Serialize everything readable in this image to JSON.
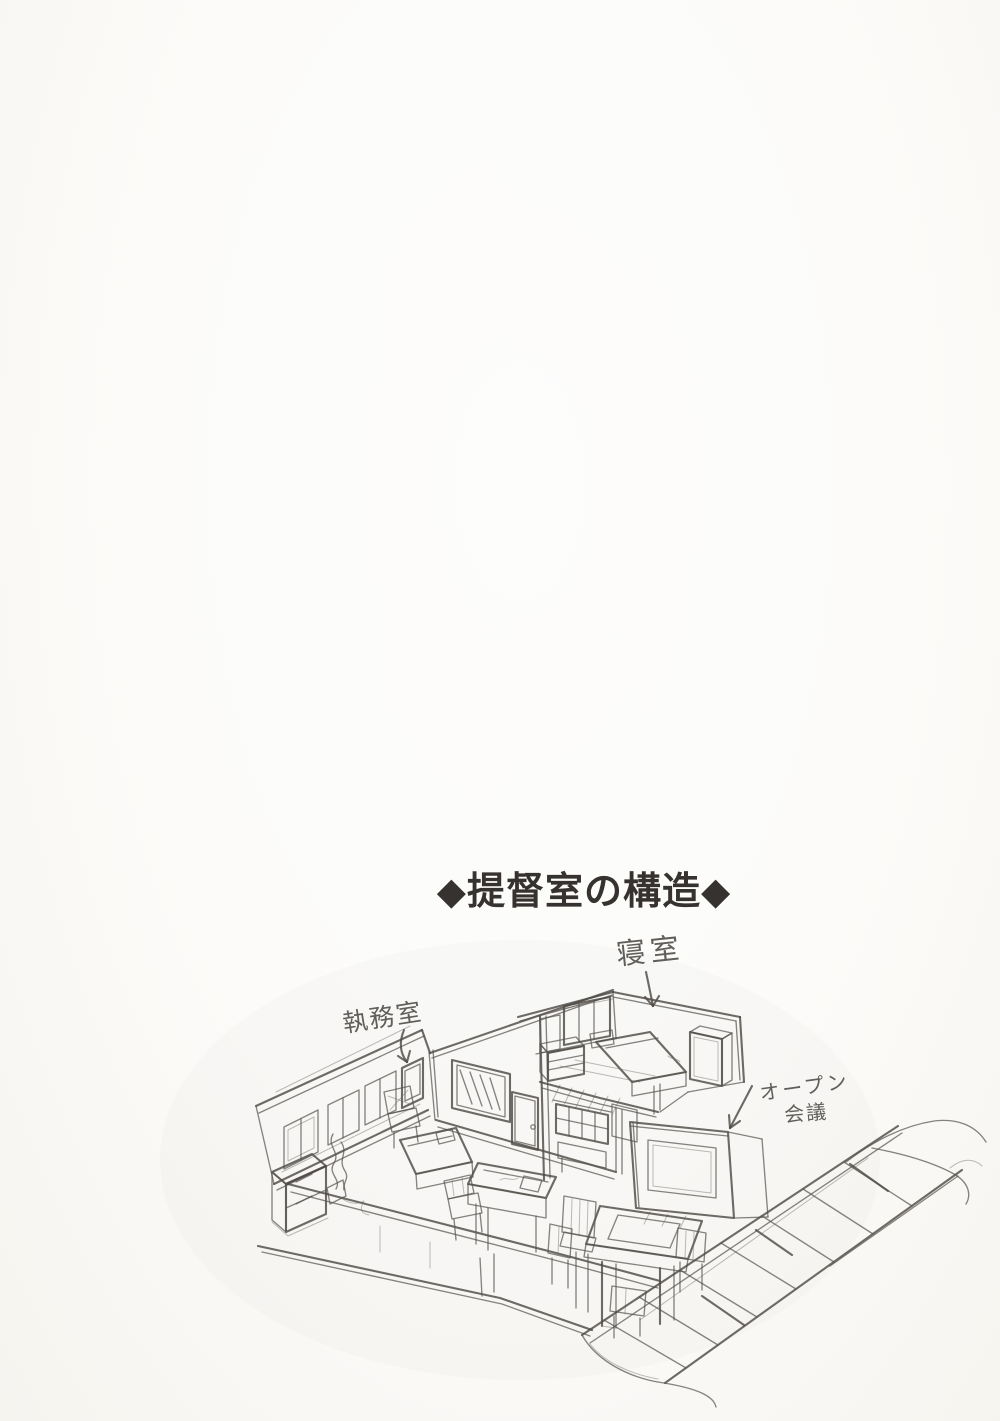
{
  "page": {
    "paper_color": "#fbfaf7",
    "pencil_color": "#57544f",
    "title_color": "#363230"
  },
  "title": {
    "text": "◆提督室の構造◆"
  },
  "sketch_labels": {
    "bedroom": "寝室",
    "office": "執務室",
    "open_meeting_line1": "オープン",
    "open_meeting_line2": "会議"
  }
}
